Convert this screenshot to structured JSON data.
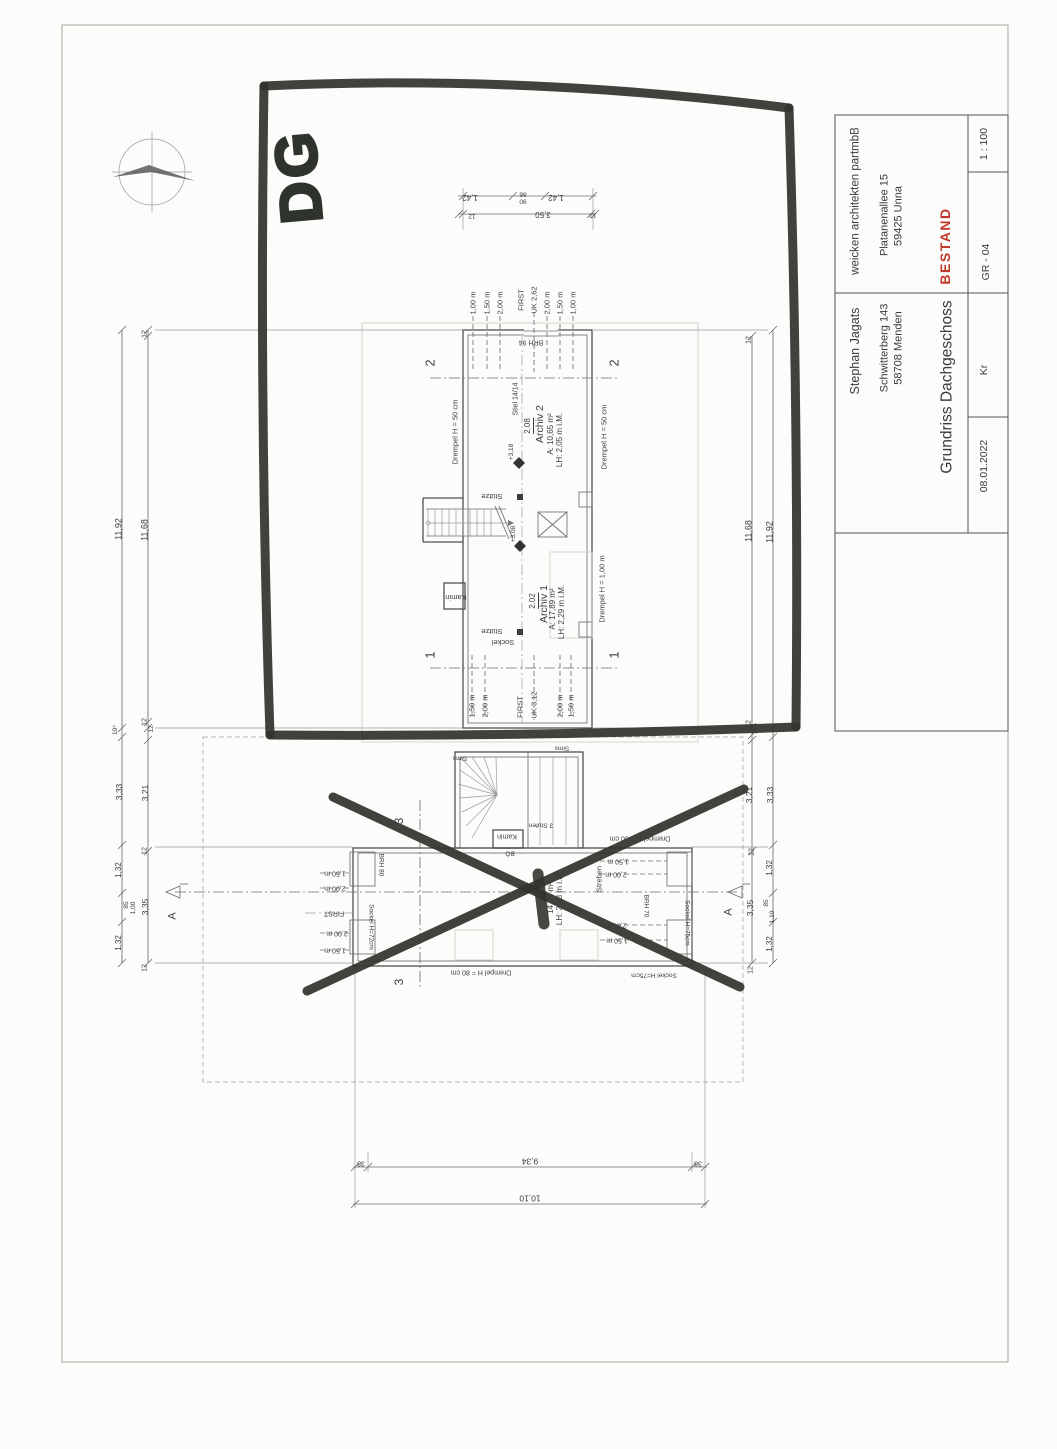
{
  "title_block": {
    "architect": "weicken architekten partmbB",
    "architect_street": "Platanenallee 15",
    "architect_city": "59425 Unna",
    "status": "BESTAND",
    "scale": "1 : 100",
    "sheet_number": "GR - 04",
    "client": "Stephan Jagats",
    "client_street": "Schwitterberg 143",
    "client_city": "58708 Menden",
    "drawing_title": "Grundriss Dachgeschoss",
    "date": "08.01.2022",
    "author": "Kr"
  },
  "colors": {
    "marker_pen": "#31342f",
    "status_red": "#c0392b",
    "line": "#4f4f4f"
  },
  "marker_annotation": "DG",
  "labels": [
    {
      "n": "height-line-label",
      "t": "1,00 m",
      "x": 473,
      "y": 303,
      "s": 7.5
    },
    {
      "n": "height-line-label",
      "t": "1,50 m",
      "x": 487,
      "y": 303,
      "s": 7.5
    },
    {
      "n": "height-line-label",
      "t": "2,00 m",
      "x": 500,
      "y": 303,
      "s": 7.5
    },
    {
      "n": "first-label",
      "t": "FIRST",
      "x": 521,
      "y": 300,
      "s": 7.5
    },
    {
      "n": "uk-label",
      "t": "UK 2,62",
      "x": 534,
      "y": 300,
      "s": 7.5
    },
    {
      "n": "height-line-label",
      "t": "2,00 m",
      "x": 547,
      "y": 303,
      "s": 7.5
    },
    {
      "n": "height-line-label",
      "t": "1,50 m",
      "x": 560,
      "y": 303,
      "s": 7.5
    },
    {
      "n": "height-line-label",
      "t": "1,00 m",
      "x": 573,
      "y": 303,
      "s": 7.5
    },
    {
      "n": "brh-label",
      "t": "BRH 94",
      "x": 531,
      "y": 342,
      "r": 180,
      "s": 7
    },
    {
      "n": "section-marker-label",
      "t": "2",
      "x": 430,
      "y": 363,
      "s": 13
    },
    {
      "n": "section-marker-label",
      "t": "2",
      "x": 614,
      "y": 363,
      "s": 13
    },
    {
      "n": "section-marker-label",
      "t": "1",
      "x": 430,
      "y": 655,
      "s": 13
    },
    {
      "n": "section-marker-label",
      "t": "1",
      "x": 614,
      "y": 655,
      "s": 13
    },
    {
      "n": "drempel-label",
      "t": "Drempel H = 50 cm",
      "x": 455,
      "y": 432,
      "s": 7.5
    },
    {
      "n": "drempel-label",
      "t": "Drempel H = 50 cm",
      "x": 604,
      "y": 437,
      "s": 7.5
    },
    {
      "n": "drempel-label",
      "t": "Drempel H = 1,00 m",
      "x": 602,
      "y": 589,
      "s": 7.5
    },
    {
      "n": "stiel-label",
      "t": "Stiel 14/14",
      "x": 516,
      "y": 399,
      "s": 7
    },
    {
      "n": "room-number",
      "t": "2.08",
      "x": 529,
      "y": 426,
      "u": 1,
      "s": 8
    },
    {
      "n": "room-name",
      "t": "Archiv 2",
      "x": 540,
      "y": 424,
      "s": 10.5
    },
    {
      "n": "room-area",
      "t": "A: 10,65 m²",
      "x": 551,
      "y": 434,
      "s": 8
    },
    {
      "n": "room-height",
      "t": "LH: 2,05 m i.M.",
      "x": 560,
      "y": 440,
      "s": 8
    },
    {
      "n": "level-label",
      "t": "+3,18",
      "x": 512,
      "y": 452,
      "s": 6.5
    },
    {
      "n": "level-label",
      "t": "+3,08",
      "x": 514,
      "y": 534,
      "s": 6.5
    },
    {
      "n": "stuetze-label",
      "t": "Stütze",
      "x": 492,
      "y": 496,
      "r": 180,
      "s": 7.5
    },
    {
      "n": "stuetze-label",
      "t": "Stütze",
      "x": 492,
      "y": 631,
      "r": 180,
      "s": 7.5
    },
    {
      "n": "kamin-label",
      "t": "Kamin",
      "x": 456,
      "y": 597,
      "r": 180,
      "s": 7.5
    },
    {
      "n": "sockel-label",
      "t": "Sockel",
      "x": 503,
      "y": 642,
      "r": 180,
      "s": 7.5
    },
    {
      "n": "room-number",
      "t": "2.02",
      "x": 534,
      "y": 601,
      "u": 1,
      "s": 8
    },
    {
      "n": "room-name",
      "t": "Archiv 1",
      "x": 544,
      "y": 604,
      "s": 10.5
    },
    {
      "n": "room-area",
      "t": "A: 17,89 m²",
      "x": 553,
      "y": 609,
      "s": 8
    },
    {
      "n": "room-height",
      "t": "LH: 2,29 m i.M.",
      "x": 562,
      "y": 612,
      "s": 8
    },
    {
      "n": "height-line-label",
      "t": "1,50 m",
      "x": 472,
      "y": 706,
      "s": 7.5
    },
    {
      "n": "height-line-label",
      "t": "2,00 m",
      "x": 485,
      "y": 706,
      "s": 7.5
    },
    {
      "n": "first-label",
      "t": "FIRST",
      "x": 520,
      "y": 707,
      "s": 7.5
    },
    {
      "n": "uk-label",
      "t": "UK 3,12",
      "x": 534,
      "y": 705,
      "s": 7.5
    },
    {
      "n": "height-line-label",
      "t": "2,00 m",
      "x": 560,
      "y": 706,
      "s": 7.5
    },
    {
      "n": "height-line-label",
      "t": "1,50 m",
      "x": 571,
      "y": 706,
      "s": 7.5
    },
    {
      "n": "dim-label",
      "t": "1,42",
      "x": 470,
      "y": 197,
      "r": 180,
      "s": 8
    },
    {
      "n": "dim-label",
      "t": "86",
      "x": 523,
      "y": 193,
      "r": 180,
      "s": 6.5
    },
    {
      "n": "dim-label",
      "t": "90",
      "x": 523,
      "y": 200,
      "r": 180,
      "s": 6.5
    },
    {
      "n": "dim-label",
      "t": "1,42",
      "x": 556,
      "y": 197,
      "r": 180,
      "s": 8
    },
    {
      "n": "dim-label",
      "t": "12",
      "x": 472,
      "y": 215,
      "r": 180,
      "s": 6.5
    },
    {
      "n": "dim-label",
      "t": "3,50",
      "x": 543,
      "y": 214,
      "r": 180,
      "s": 8
    },
    {
      "n": "dim-label",
      "t": "12",
      "x": 593,
      "y": 214,
      "r": 180,
      "s": 6.5
    },
    {
      "n": "dim-label",
      "t": "11,92",
      "x": 119,
      "y": 529,
      "s": 9
    },
    {
      "n": "dim-label",
      "t": "12",
      "x": 145,
      "y": 334,
      "s": 7
    },
    {
      "n": "dim-label",
      "t": "11,68",
      "x": 145,
      "y": 530,
      "s": 9
    },
    {
      "n": "dim-label",
      "t": "12",
      "x": 145,
      "y": 722,
      "s": 7
    },
    {
      "n": "dim-label",
      "t": "12",
      "x": 152,
      "y": 729,
      "s": 6.5
    },
    {
      "n": "dim-label",
      "t": "10⁵",
      "x": 116,
      "y": 730,
      "s": 6.5
    },
    {
      "n": "dim-label",
      "t": "3,33",
      "x": 119,
      "y": 792,
      "s": 8.5
    },
    {
      "n": "dim-label",
      "t": "3,21",
      "x": 145,
      "y": 793,
      "s": 8.5
    },
    {
      "n": "dim-label",
      "t": "12",
      "x": 145,
      "y": 851,
      "s": 7
    },
    {
      "n": "dim-label",
      "t": "1,32",
      "x": 119,
      "y": 870,
      "s": 8
    },
    {
      "n": "dim-label",
      "t": "85",
      "x": 127,
      "y": 905,
      "s": 6.5
    },
    {
      "n": "dim-label",
      "t": "1,00",
      "x": 134,
      "y": 908,
      "s": 6.5
    },
    {
      "n": "dim-label",
      "t": "3,35",
      "x": 145,
      "y": 907,
      "s": 8.5
    },
    {
      "n": "dim-label",
      "t": "1,32",
      "x": 119,
      "y": 943,
      "s": 8
    },
    {
      "n": "dim-label",
      "t": "12",
      "x": 145,
      "y": 968,
      "s": 7
    },
    {
      "n": "dim-label",
      "t": "12",
      "x": 749,
      "y": 340,
      "s": 7
    },
    {
      "n": "dim-label",
      "t": "11,68",
      "x": 749,
      "y": 531,
      "s": 9
    },
    {
      "n": "dim-label",
      "t": "11,92",
      "x": 770,
      "y": 532,
      "s": 9
    },
    {
      "n": "dim-label",
      "t": "12",
      "x": 749,
      "y": 724,
      "s": 7
    },
    {
      "n": "dim-label",
      "t": "12",
      "x": 756,
      "y": 731,
      "s": 6.5
    },
    {
      "n": "dim-label",
      "t": "3,21",
      "x": 749,
      "y": 795,
      "s": 8.5
    },
    {
      "n": "dim-label",
      "t": "3,33",
      "x": 770,
      "y": 795,
      "s": 8.5
    },
    {
      "n": "dim-label",
      "t": "12",
      "x": 752,
      "y": 852,
      "s": 7
    },
    {
      "n": "dim-label",
      "t": "1,32",
      "x": 770,
      "y": 868,
      "s": 8
    },
    {
      "n": "dim-label",
      "t": "85",
      "x": 767,
      "y": 903,
      "s": 6.5
    },
    {
      "n": "dim-label",
      "t": "1,10",
      "x": 773,
      "y": 917,
      "s": 6.5
    },
    {
      "n": "dim-label",
      "t": "3,35",
      "x": 750,
      "y": 908,
      "s": 8.5
    },
    {
      "n": "dim-label",
      "t": "1,32",
      "x": 770,
      "y": 944,
      "s": 8
    },
    {
      "n": "dim-label",
      "t": "12",
      "x": 751,
      "y": 970,
      "s": 7
    },
    {
      "n": "sims-label",
      "t": "Sims",
      "x": 460,
      "y": 757,
      "r": 180,
      "s": 6.5
    },
    {
      "n": "sims-label",
      "t": "Sims",
      "x": 562,
      "y": 747,
      "r": 180,
      "s": 6.5
    },
    {
      "n": "kamin-label",
      "t": "Kamin",
      "x": 507,
      "y": 836,
      "r": 180,
      "s": 7
    },
    {
      "n": "boe-label",
      "t": "BÖ",
      "x": 510,
      "y": 852,
      "r": 180,
      "s": 6.5
    },
    {
      "n": "stufen-label",
      "t": "3 Stufen",
      "x": 541,
      "y": 824,
      "r": 180,
      "s": 6.5
    },
    {
      "n": "drempel-label",
      "t": "Drempel H = 80 cm",
      "x": 640,
      "y": 838,
      "r": 180,
      "s": 7
    },
    {
      "n": "drempel-label",
      "t": "Drempel H = 80 cm",
      "x": 481,
      "y": 972,
      "r": 180,
      "s": 7
    },
    {
      "n": "sockel-label",
      "t": "Sockel H=75cm",
      "x": 654,
      "y": 974,
      "r": 180,
      "s": 6.5
    },
    {
      "n": "sockel-label",
      "t": "Sockel H=72cm",
      "x": 370,
      "y": 927,
      "r": 90,
      "s": 6.5
    },
    {
      "n": "brh-label",
      "t": "BRH 80",
      "x": 380,
      "y": 865,
      "r": 90,
      "s": 6.5
    },
    {
      "n": "brh-label",
      "t": "BRH 70",
      "x": 645,
      "y": 906,
      "r": 90,
      "s": 6.5
    },
    {
      "n": "sockel-label",
      "t": "Sockel H=75cm",
      "x": 686,
      "y": 923,
      "r": 90,
      "s": 6.5
    },
    {
      "n": "room-area",
      "t": "14,74 m²",
      "x": 551,
      "y": 898,
      "s": 8
    },
    {
      "n": "room-height",
      "t": "LH: 2,08 m i.M.",
      "x": 560,
      "y": 898,
      "s": 8
    },
    {
      "n": "streben-label",
      "t": "Streben",
      "x": 599,
      "y": 879,
      "s": 7.5
    },
    {
      "n": "height-line-label",
      "t": "1,50 m",
      "x": 618,
      "y": 861,
      "r": 180,
      "s": 7
    },
    {
      "n": "height-line-label",
      "t": "2,00 m",
      "x": 616,
      "y": 874,
      "r": 180,
      "s": 7
    },
    {
      "n": "height-line-label",
      "t": "2,00 m",
      "x": 616,
      "y": 925,
      "r": 180,
      "s": 7
    },
    {
      "n": "height-line-label",
      "t": "1,50 m",
      "x": 617,
      "y": 940,
      "r": 180,
      "s": 7
    },
    {
      "n": "height-line-label",
      "t": "1,50 m",
      "x": 335,
      "y": 873,
      "r": 180,
      "s": 7
    },
    {
      "n": "height-line-label",
      "t": "2,00 m",
      "x": 335,
      "y": 888,
      "r": 180,
      "s": 7
    },
    {
      "n": "first-label",
      "t": "FIRST",
      "x": 334,
      "y": 913,
      "r": 180,
      "s": 7
    },
    {
      "n": "height-line-label",
      "t": "2,00 m",
      "x": 337,
      "y": 933,
      "r": 180,
      "s": 7
    },
    {
      "n": "height-line-label",
      "t": "1,50 m",
      "x": 335,
      "y": 950,
      "r": 180,
      "s": 7
    },
    {
      "n": "section-marker-label",
      "t": "3",
      "x": 399,
      "y": 821,
      "s": 12
    },
    {
      "n": "section-marker-label",
      "t": "3",
      "x": 399,
      "y": 982,
      "s": 12
    },
    {
      "n": "section-marker-label",
      "t": "A",
      "x": 173,
      "y": 916,
      "s": 11
    },
    {
      "n": "section-marker-label",
      "t": "A",
      "x": 729,
      "y": 912,
      "s": 11
    },
    {
      "n": "dim-label",
      "t": "38",
      "x": 361,
      "y": 1163,
      "r": 180,
      "s": 7
    },
    {
      "n": "dim-label",
      "t": "9,34",
      "x": 530,
      "y": 1161,
      "r": 180,
      "s": 8.5
    },
    {
      "n": "dim-label",
      "t": "38",
      "x": 698,
      "y": 1163,
      "r": 180,
      "s": 7
    },
    {
      "n": "dim-label",
      "t": "10,10",
      "x": 530,
      "y": 1198,
      "r": 180,
      "s": 8.5
    },
    {
      "n": "dg-marker-text",
      "t": "DG",
      "x": 299,
      "y": 176,
      "r": -95,
      "s": 58,
      "k": "marker-text"
    }
  ]
}
